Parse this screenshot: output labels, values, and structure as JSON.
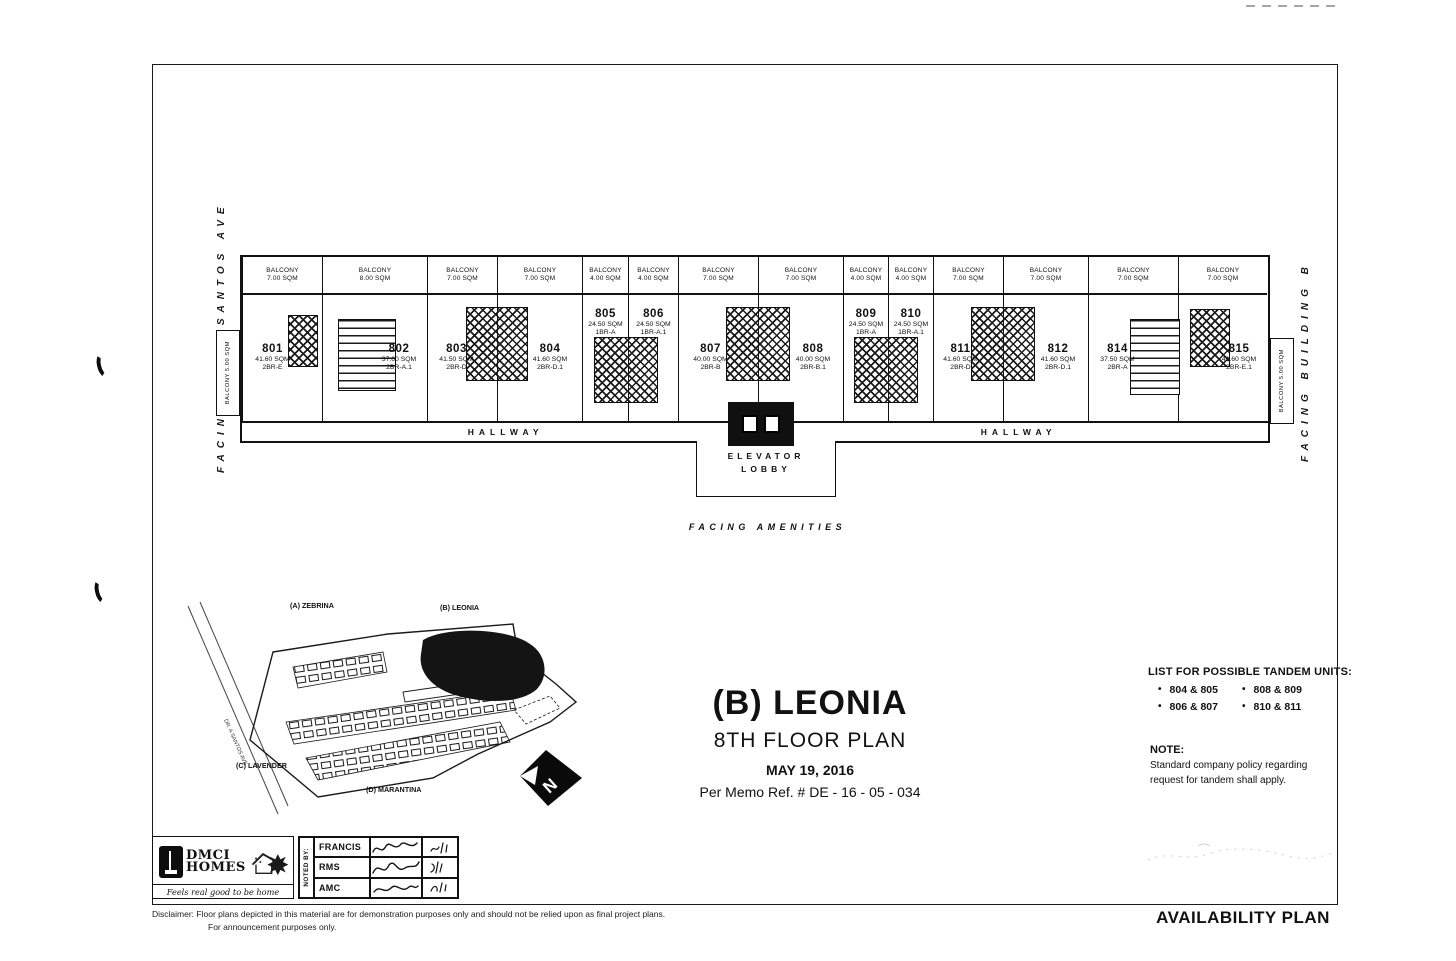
{
  "page": {
    "availability_title": "AVAILABILITY PLAN",
    "disclaimer_label": "Disclaimer:",
    "disclaimer_line1": "Floor plans depicted in this material are for demonstration purposes only and should not be relied upon as final project plans.",
    "disclaimer_line2": "For announcement purposes only."
  },
  "floorplan": {
    "facing_left": "FACING DR. A SANTOS AVE",
    "facing_right": "FACING BUILDING B",
    "facing_amenities": "FACING AMENITIES",
    "hallway_left": "HALLWAY",
    "hallway_right": "HALLWAY",
    "elevator_lobby_line1": "ELEVATOR",
    "elevator_lobby_line2": "LOBBY",
    "balcony_word": "BALCONY",
    "side_balcony_left": "BALCONY 5.00 SQM",
    "side_balcony_right": "BALCONY 5.00 SQM",
    "units": [
      {
        "no": "801",
        "sqm": "41.60 SQM",
        "type": "2BR-E",
        "balcony": "7.00 SQM",
        "w": 80,
        "dx": -10
      },
      {
        "no": "802",
        "sqm": "37.60 SQM",
        "type": "2BR-A.1",
        "balcony": "8.00 SQM",
        "w": 105,
        "dx": 24
      },
      {
        "no": "803",
        "sqm": "41.50 SQM",
        "type": "2BR-D",
        "balcony": "7.00 SQM",
        "w": 70,
        "dx": -6
      },
      {
        "no": "804",
        "sqm": "41.60 SQM",
        "type": "2BR-D.1",
        "balcony": "7.00 SQM",
        "w": 85,
        "dx": 10
      },
      {
        "no": "805",
        "sqm": "24.50 SQM",
        "type": "1BR-A",
        "balcony": "4.00 SQM",
        "w": 46,
        "label_top": 10
      },
      {
        "no": "806",
        "sqm": "24.50 SQM",
        "type": "1BR-A.1",
        "balcony": "4.00 SQM",
        "w": 50,
        "label_top": 10
      },
      {
        "no": "807",
        "sqm": "40.00 SQM",
        "type": "2BR-B",
        "balcony": "7.00 SQM",
        "w": 80,
        "dx": -8
      },
      {
        "no": "808",
        "sqm": "40.00 SQM",
        "type": "2BR-B.1",
        "balcony": "7.00 SQM",
        "w": 85,
        "dx": 12
      },
      {
        "no": "809",
        "sqm": "24.50 SQM",
        "type": "1BR-A",
        "balcony": "4.00 SQM",
        "w": 45,
        "label_top": 10
      },
      {
        "no": "810",
        "sqm": "24.50 SQM",
        "type": "1BR-A.1",
        "balcony": "4.00 SQM",
        "w": 45,
        "label_top": 10
      },
      {
        "no": "811",
        "sqm": "41.60 SQM",
        "type": "2BR-D",
        "balcony": "7.00 SQM",
        "w": 70,
        "dx": -8
      },
      {
        "no": "812",
        "sqm": "41.60 SQM",
        "type": "2BR-D.1",
        "balcony": "7.00 SQM",
        "w": 85,
        "dx": 12
      },
      {
        "no": "814",
        "sqm": "37.50 SQM",
        "type": "2BR-A",
        "balcony": "7.00 SQM",
        "w": 90,
        "dx": -16
      },
      {
        "no": "815",
        "sqm": "41.60 SQM",
        "type": "2BR-E.1",
        "balcony": "7.00 SQM",
        "w": 89,
        "dx": 16
      }
    ]
  },
  "sitemap": {
    "road_label": "DR. A SANTOS AVE",
    "buildings": {
      "a": "(A) ZEBRINA",
      "b": "(B) LEONIA",
      "c": "(C) LAVENDER",
      "d": "(D) MARANTINA"
    },
    "north_letter": "N"
  },
  "title_block": {
    "building": "(B) LEONIA",
    "floor": "8TH FLOOR PLAN",
    "date": "MAY 19, 2016",
    "memo": "Per Memo Ref. #  DE - 16 - 05 - 034"
  },
  "tandem": {
    "heading": "LIST FOR POSSIBLE TANDEM UNITS:",
    "col1": [
      "804 & 805",
      "806 & 807"
    ],
    "col2": [
      "808 & 809",
      "810 & 811"
    ]
  },
  "note": {
    "heading": "NOTE:",
    "line1": "Standard company policy regarding",
    "line2": "request for tandem shall apply."
  },
  "noted_by": {
    "label": "NOTED BY:",
    "rows": [
      "FRANCIS",
      "RMS",
      "AMC"
    ]
  },
  "logo": {
    "name_line1": "DMCI",
    "name_line2": "HOMES",
    "tagline": "Feels real good to be home"
  },
  "colors": {
    "ink": "#111111",
    "paper": "#ffffff"
  }
}
